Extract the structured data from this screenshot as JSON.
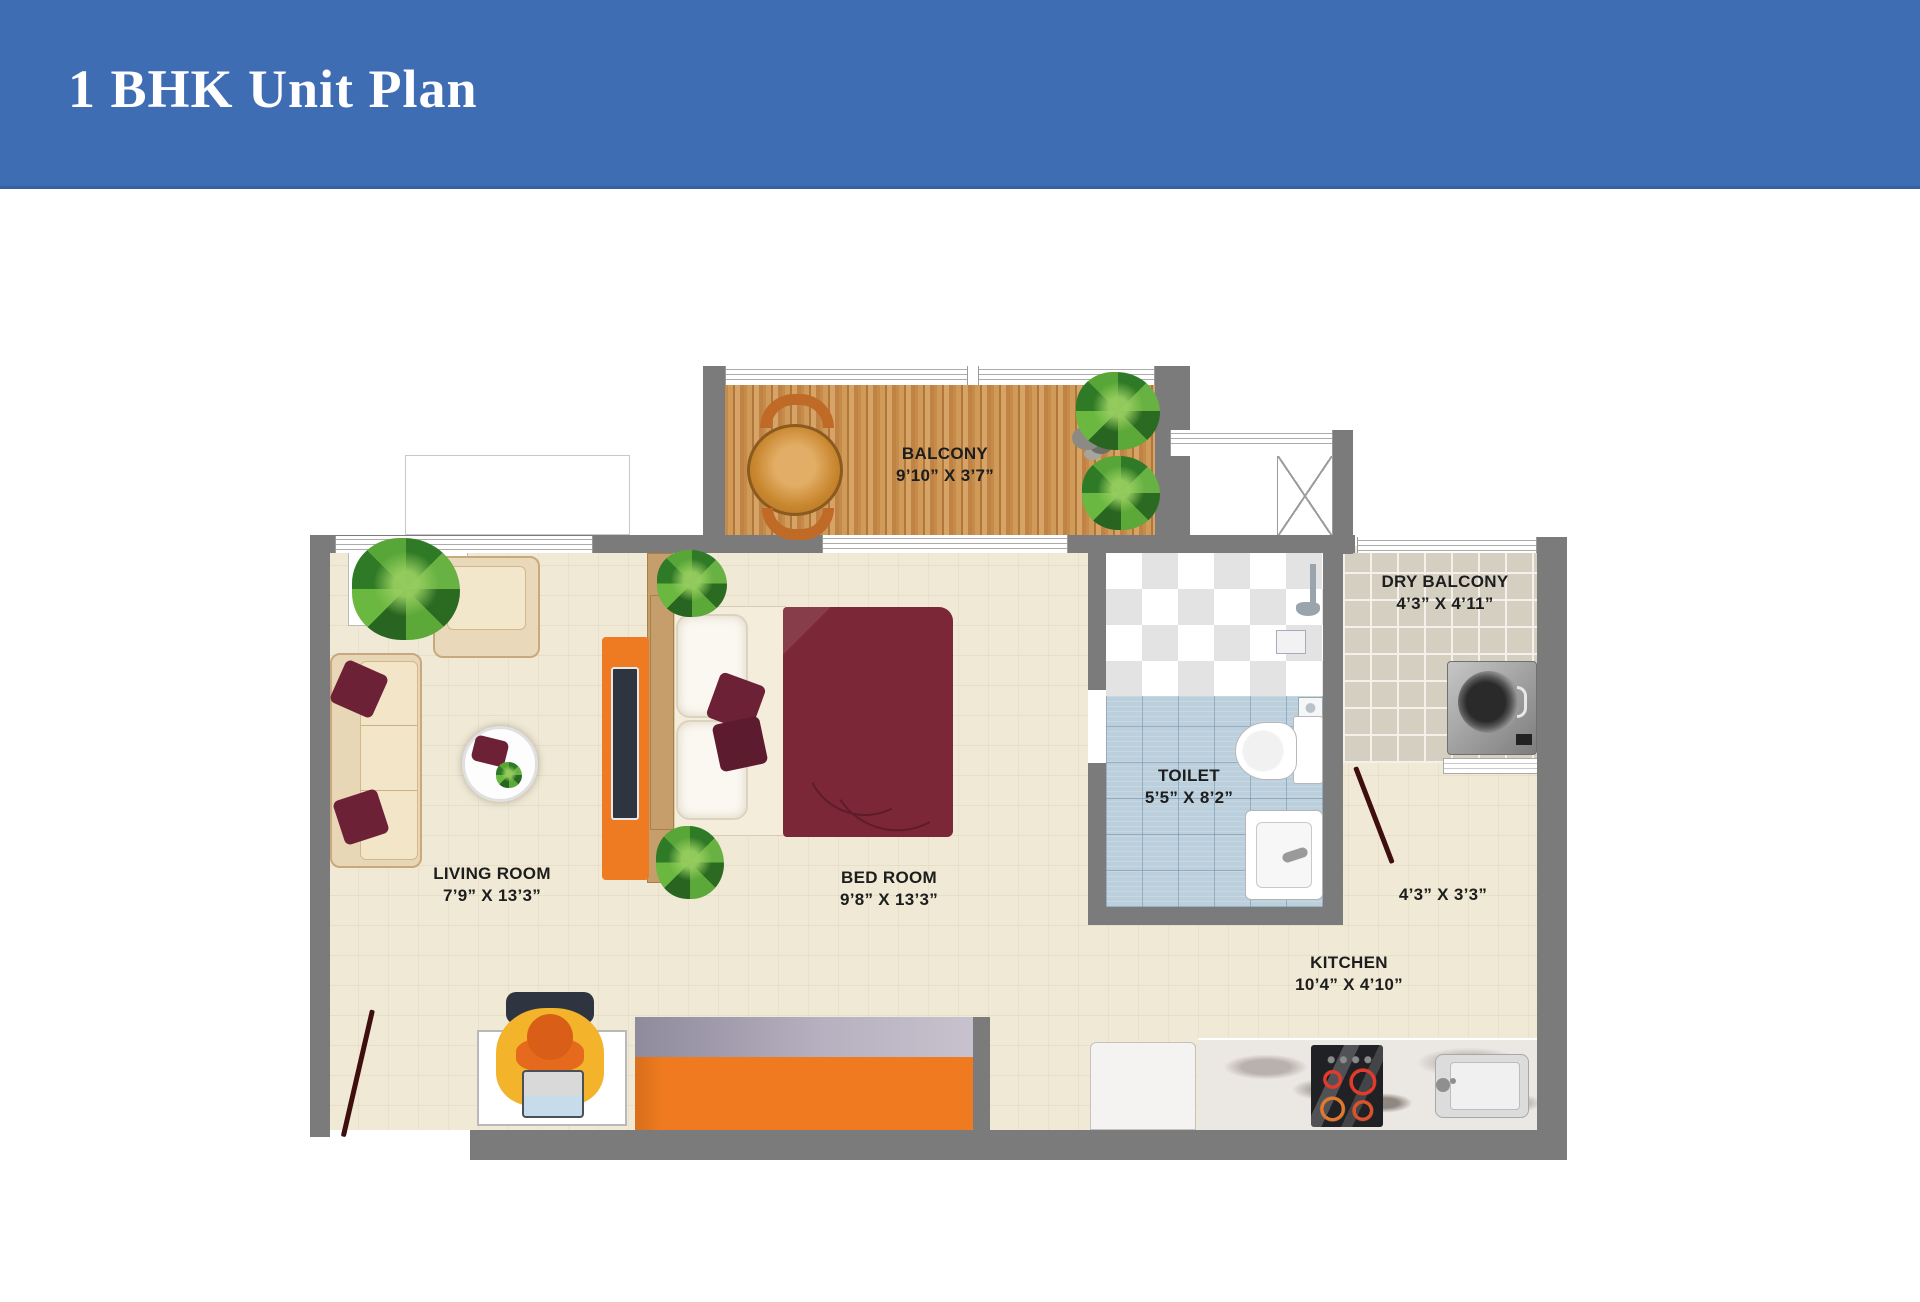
{
  "header": {
    "title": "1 BHK Unit Plan"
  },
  "plan": {
    "rooms": [
      {
        "id": "balcony",
        "label": "BALCONY",
        "dims": "9’10” X 3’7”"
      },
      {
        "id": "living-room",
        "label": "LIVING ROOM",
        "dims": "7’9” X 13’3”"
      },
      {
        "id": "bed-room",
        "label": "BED ROOM",
        "dims": "9’8” X 13’3”"
      },
      {
        "id": "toilet",
        "label": "TOILET",
        "dims": "5’5” X 8’2”"
      },
      {
        "id": "dry-balcony",
        "label": "DRY BALCONY",
        "dims": "4’3” X 4’11”"
      },
      {
        "id": "kitchen",
        "label": "KITCHEN",
        "dims": "10’4” X 4’10”"
      },
      {
        "id": "passage",
        "label": "",
        "dims": "4’3” X 3’3”"
      }
    ]
  },
  "colors": {
    "header_bg": "#3f6db4",
    "header_text": "#ffffff",
    "wall_gray": "#7b7b7b",
    "floor_beige": "#f0e9d6",
    "balcony_wood": "#c68c4b",
    "toilet_tile_blue": "#bccfdd",
    "dry_tile": "#d5cfc1",
    "furniture_orange": "#ee7a22",
    "bed_maroon": "#7b2737",
    "label_text": "#1d1d1d"
  }
}
